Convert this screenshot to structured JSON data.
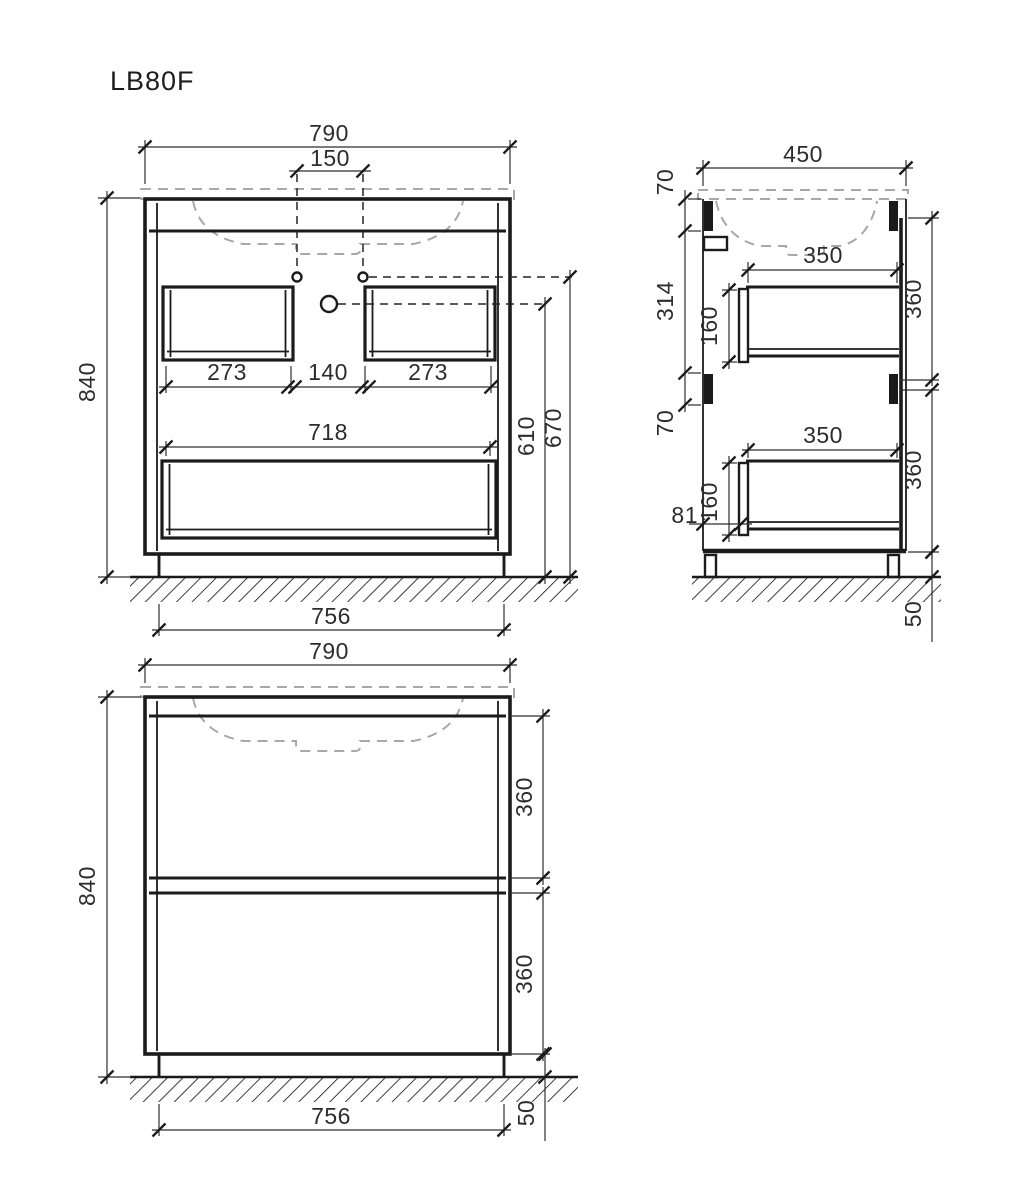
{
  "title": "LB80F",
  "front_view": {
    "overall_width": "790",
    "faucet_spacing": "150",
    "height": "840",
    "left_drawer_width": "273",
    "center_gap": "140",
    "right_drawer_width": "273",
    "lower_drawer_width": "718",
    "drain_height": "610",
    "faucet_height": "670",
    "base_span": "756"
  },
  "side_view": {
    "depth": "450",
    "top_rail": "70",
    "upper_section": "314",
    "mid_rail": "70",
    "upper_drawer_depth": "350",
    "upper_drawer_height": "160",
    "upper_front_height": "360",
    "lower_drawer_depth": "350",
    "lower_drawer_height": "160",
    "lower_front_height": "360",
    "front_setback": "81",
    "leg_height": "50"
  },
  "bottom_view": {
    "overall_width": "790",
    "height": "840",
    "upper_front_height": "360",
    "lower_front_height": "360",
    "base_span": "756",
    "leg_height": "50"
  },
  "colors": {
    "line": "#1b1b1b",
    "dim_text": "#2d2d2d",
    "ghost_dashed": "#a8a8a8",
    "background": "#ffffff"
  }
}
